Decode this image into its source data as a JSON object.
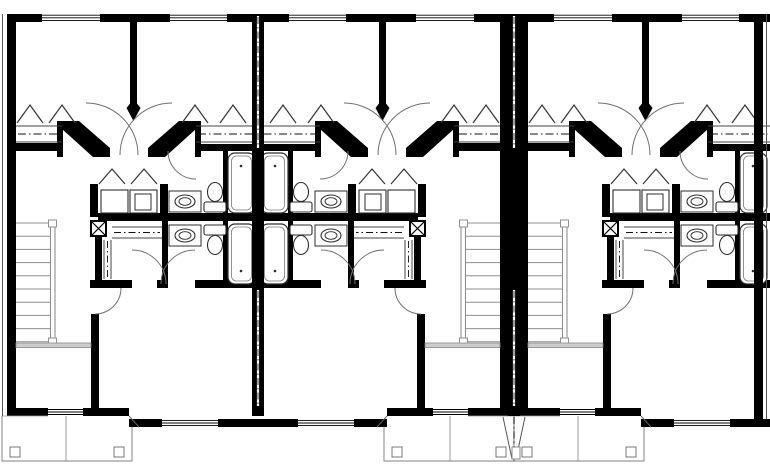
{
  "title": "Triplex townhouse upper floor plan",
  "canvas": {
    "width": 770,
    "height": 465
  },
  "colors": {
    "background": "#ffffff",
    "walls": "#000000",
    "fixtures": "#2e2e2e",
    "thin_lines": "#555555",
    "arc_lines": "#707070",
    "stairs": "#8f8f8f",
    "deck_lines": "#9a9a9a",
    "landing_fill": "#cccccc",
    "dash_dot": "#111111"
  },
  "units": [
    {
      "id": "unit-1",
      "offset": 0,
      "mirrored": false
    },
    {
      "id": "unit-2",
      "offset": 516,
      "mirrored": true
    },
    {
      "id": "unit-3",
      "offset": 512,
      "mirrored": false
    }
  ],
  "party_walls": [
    {
      "x": 258,
      "steps_symbol": false
    },
    {
      "x": 514,
      "steps_symbol": true
    }
  ],
  "unit_features": [
    "bedroom-1",
    "bedroom-2",
    "bedroom-closets",
    "hall",
    "bathroom-1",
    "bathroom-2",
    "laundry-closet",
    "linen-closet",
    "staircase",
    "living-room",
    "entry",
    "deck"
  ],
  "fixture_inventory": {
    "bathtubs_per_unit": 2,
    "toilets_per_unit": 2,
    "sinks_per_unit": 2,
    "washer_dryer_per_unit": 1,
    "top_windows_per_unit": 2,
    "bottom_windows_per_unit": 1,
    "entry_doors_per_unit": 1,
    "decks_per_unit": 1
  }
}
